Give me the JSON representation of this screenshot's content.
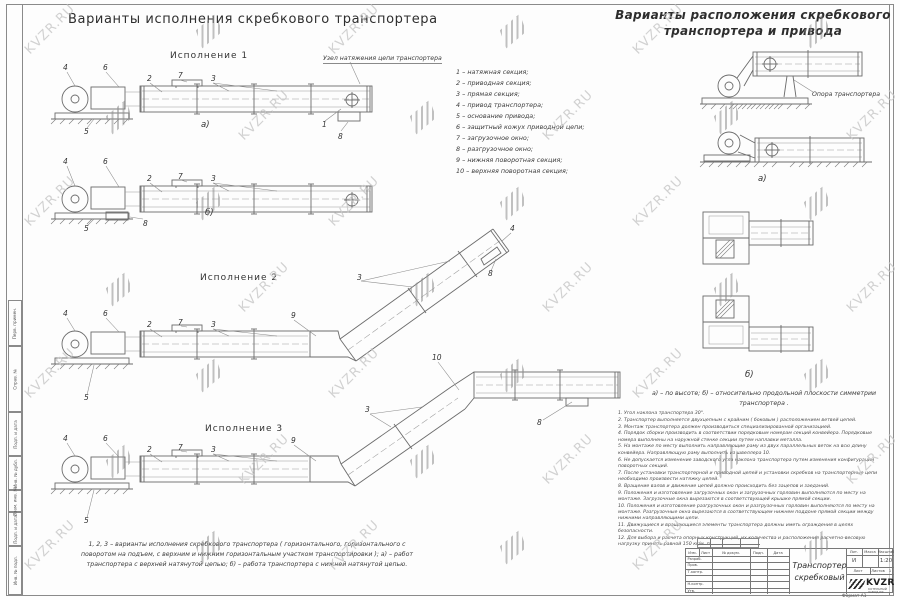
{
  "watermark": {
    "text": "KVZR.RU"
  },
  "titles": {
    "left": "Варианты исполнения скребкового транспортера",
    "right": "Варианты расположения скребкового транспортера и привода"
  },
  "left_panel": {
    "execution1": "Исполнение  1",
    "execution2": "Исполнение  2",
    "execution3": "Исполнение  3",
    "tension_label": "Узел натяжения цепи транспортера",
    "view_a": "а)",
    "view_b": "б)",
    "caption": "1, 2, 3 –  варианты исполнения скребкового транспортера ( горизонтального, горизонтального с поворотом на подъем, с верхним и нижним горизонтальным участком транспортировки );  а) –  работ транспортера с верхней натянутой цепью;  б) –  работа транспортера с нижней натянутой цепью."
  },
  "legend": {
    "items": [
      "1 –  натяжная секция;",
      "2 –  приводная секция;",
      "3 –  прямая секция;",
      "4 –  привод транспортера;",
      "5 –  основание привода;",
      "6 –  защитный кожух приводной цепи;",
      "7 –  загрузочное окно;",
      "8 –  разгрузочное окно;",
      "9 –  нижняя поворотная секция;",
      "10 –  верхняя поворотная секция;"
    ]
  },
  "right_panel": {
    "support_label": "Опора транспортера",
    "caption": "а) –  по высоте;  б) –  относительно продольной плоскости симметрии транспортера ."
  },
  "notes": [
    "1. Угол наклона транспортера 30°.",
    "2. Транспортер выполняется двухцепным с крайним ( боковым ) расположением ветвей цепей.",
    "3. Монтаж транспортера должен производиться специализированной организацией.",
    "4. Порядок сборки производить в соответствии порядковым номерам секций конвейера. Порядковые номера выполнены на наружной стенке секции путем наплавки металла.",
    "5. На монтаже по месту выполнить направляющие раму из двух параллельных веток на всю длину конвейера. Направляющую раму выполнить из швеллера 10.",
    "6. Не допускается изменение заводского угла наклона транспортера путем изменения конфигурации поворотных секций.",
    "7. После установки транспортерной и приводной цепей и установки скребков на транспортерные цепи необходимо произвести натяжку цепей.",
    "8. Вращение валов и движение цепей должно происходить без зацепов и заеданий.",
    "9. Положения и изготовление загрузочных окон и загрузочных горловин выполняются по месту на монтаже. Загрузочные окна вырезаются в соответствующей крышке прямой секции.",
    "10. Положения и изготовление разгрузочных окон и разгрузочных горловин выполняются по месту на монтаже. Разгрузочные окна вырезаются в соответствующем нижнем поддоне прямой секции между нижними направляющими цепи.",
    "11. Движущиеся и вращающиеся элементы транспортера должны иметь ограждения в целях безопасности.",
    "12. Для выбора и расчета опорных конструкций, их количества и расположения расчетно-весовую нагрузку принять равной 150 кг/м. п."
  ],
  "digits": {
    "n1": "1",
    "n2": "2",
    "n3": "3",
    "n4": "4",
    "n5": "5",
    "n6": "6",
    "n7": "7",
    "n8": "8",
    "n9": "9",
    "n10": "10"
  },
  "frame": {
    "left_strip_labels": [
      "Перв. примен.",
      "Справ. №",
      "Подп. и дата",
      "Инв. № дубл.",
      "Взам. инв. №",
      "Подп. и дата",
      "Инв. № подл."
    ],
    "format_label": "Формат А1"
  },
  "title_block": {
    "doc_title": "Транспортер скребковый",
    "headers": {
      "izm": "Изм.",
      "list": "Лист",
      "doc": "№ докум.",
      "podp": "Подп.",
      "data": "Дата",
      "lit": "Лит.",
      "mass": "Масса",
      "scale": "Масштаб",
      "sheet": "Лист",
      "sheets": "Листов"
    },
    "rows": {
      "razrab": "Разраб.",
      "prov": "Пров.",
      "tkontr": "Т.контр.",
      "nkontr": "Н.контр.",
      "utv": "Утв."
    },
    "values": {
      "lit": "И",
      "scale": "1:20",
      "sheets": "1"
    },
    "logo": "KVZR",
    "logo_sub1": "КОТЕЛЬНЫЙ",
    "logo_sub2": "ЗАВОД РФ"
  }
}
